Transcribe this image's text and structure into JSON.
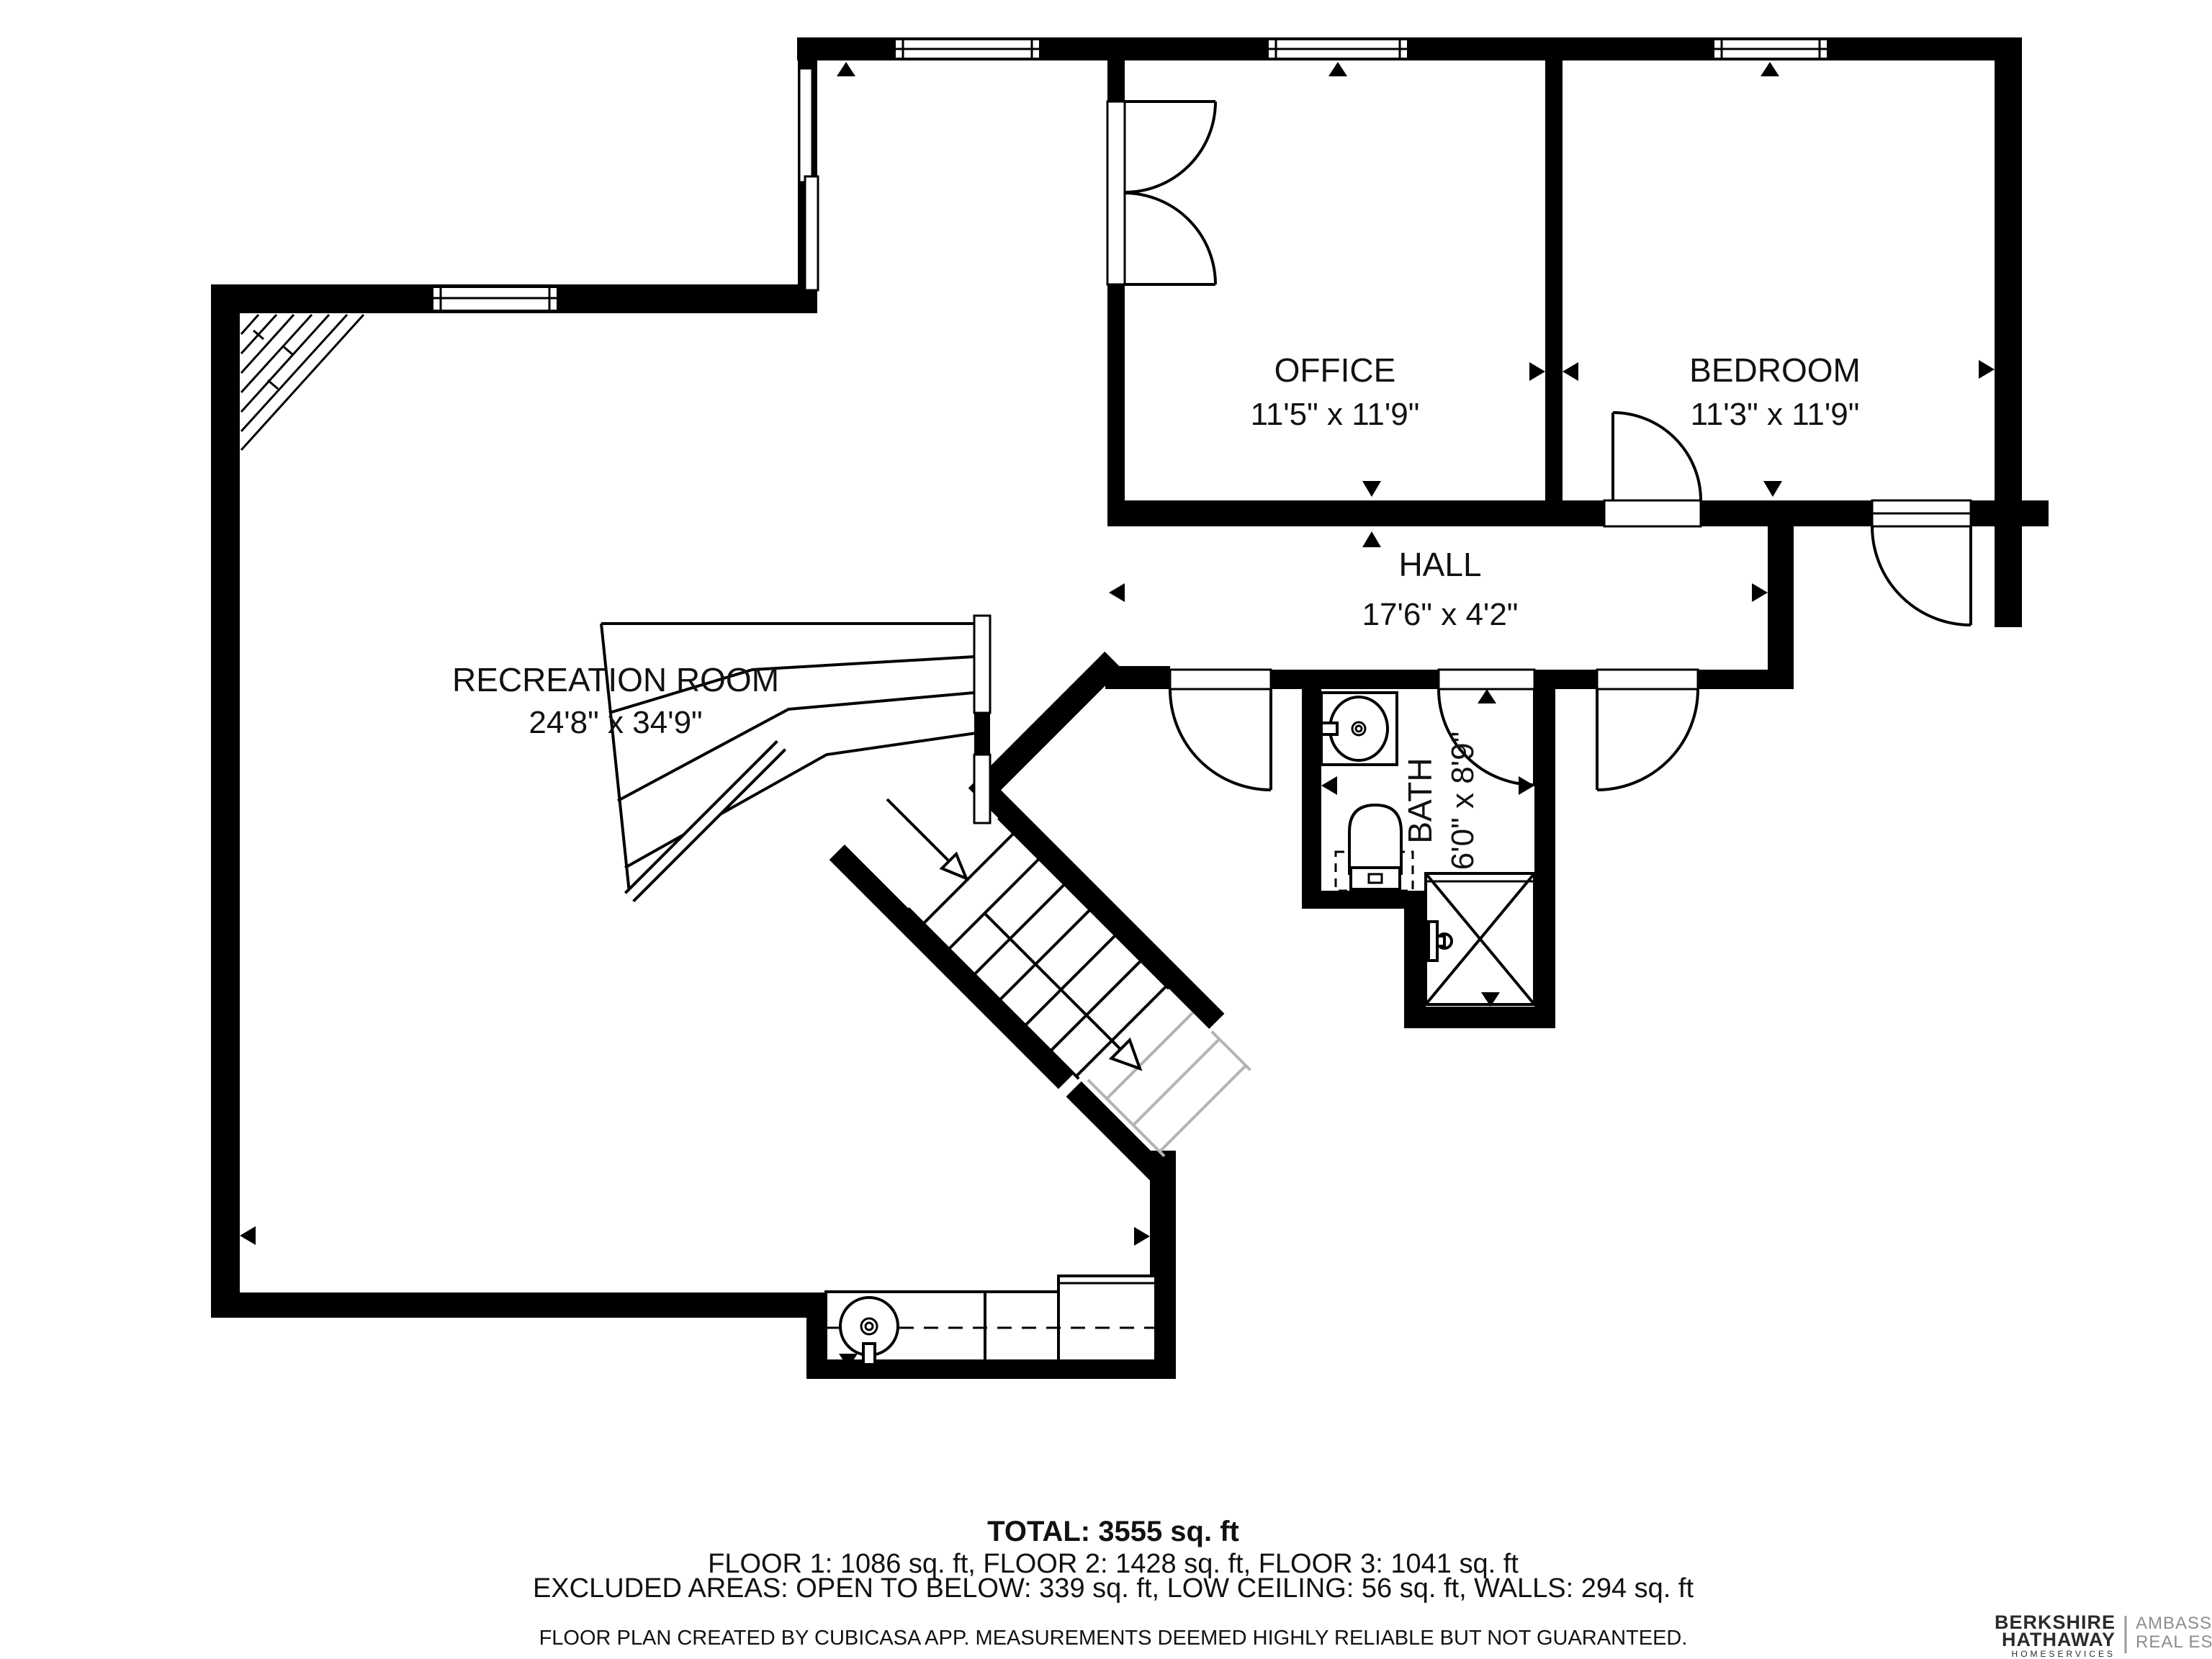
{
  "plan": {
    "title": "Floor 3 floor plan",
    "rooms": [
      {
        "name": "RECREATION ROOM",
        "dimensions": "24'8\" x 34'9\""
      },
      {
        "name": "OFFICE",
        "dimensions": "11'5\" x 11'9\""
      },
      {
        "name": "BEDROOM",
        "dimensions": "11'3\" x 11'9\""
      },
      {
        "name": "HALL",
        "dimensions": "17'6\" x 4'2\""
      },
      {
        "name": "BATH",
        "dimensions": "6'0\" x 8'9\""
      }
    ],
    "summary": {
      "total": "TOTAL: 3555 sq. ft",
      "floors": "FLOOR 1: 1086 sq. ft, FLOOR 2: 1428 sq. ft, FLOOR 3: 1041 sq. ft",
      "excluded": "EXCLUDED AREAS: OPEN TO BELOW: 339 sq. ft, LOW CEILING: 56 sq. ft, WALLS: 294 sq. ft",
      "disclaimer": "FLOOR PLAN CREATED BY CUBICASA APP. MEASUREMENTS DEEMED HIGHLY RELIABLE BUT NOT GUARANTEED."
    },
    "branding": {
      "brand_line1": "BERKSHIRE",
      "brand_line2": "HATHAWAY",
      "brand_line3": "HOMESERVICES",
      "agency_line1": "AMBASSADOR",
      "agency_line2": "REAL ESTATE"
    },
    "colors": {
      "wall": "#000000",
      "background": "#ffffff",
      "open_tread": "#b3b3b3",
      "brand_text": "#2b2b2b",
      "agency_text": "#8d8d8d"
    },
    "icons": {
      "stair-direction-arrow": "open triangle arrow along stair flight",
      "wall-marker": "small solid triangle tick on walls and openings",
      "door-swing": "quarter-circle arc with leaf line",
      "window": "white rectangle with center line in wall",
      "shower": "square with X",
      "low-ceiling-hatch": "diagonal hatched triangle"
    }
  }
}
